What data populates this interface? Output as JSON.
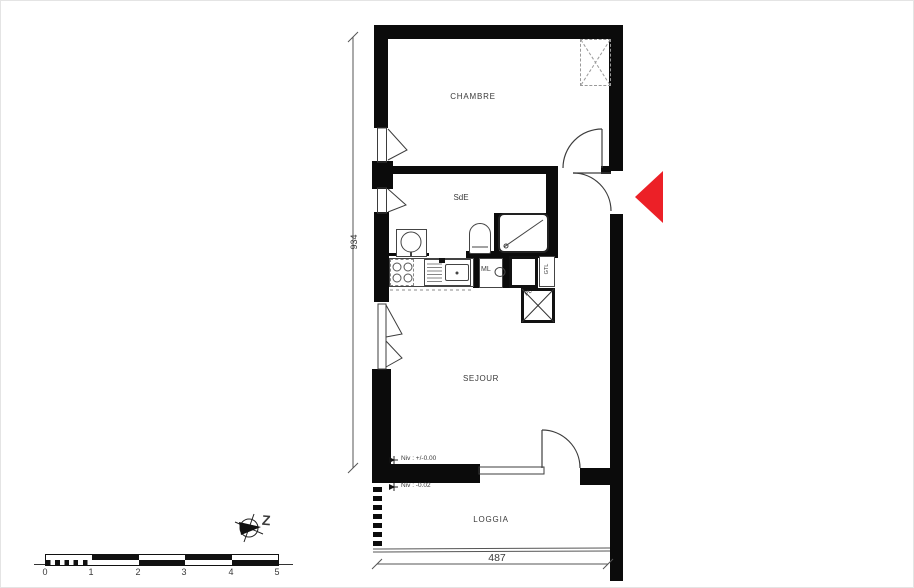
{
  "plan_title": "apartment-floor-plan",
  "rooms": {
    "chambre": "CHAMBRE",
    "sde": "SdE",
    "sejour": "SEJOUR",
    "loggia": "LOGGIA"
  },
  "fixtures": {
    "washing_machine": "ML",
    "technical_duct": "GTL",
    "closet": "PL"
  },
  "dimensions": {
    "plan_depth": "934",
    "loggia_width": "487"
  },
  "levels": {
    "main": "Niv : +/-0.00",
    "loggia": "Niv : -0.02"
  },
  "scale_bar": {
    "ticks": [
      "0",
      "1",
      "2",
      "3",
      "4",
      "5"
    ]
  },
  "compass": {
    "label": "Z"
  },
  "colors": {
    "wall": "#0b0b0b",
    "entrance_arrow": "#ec2027",
    "linework": "#3d3d3d",
    "text": "#3a3a3a"
  }
}
